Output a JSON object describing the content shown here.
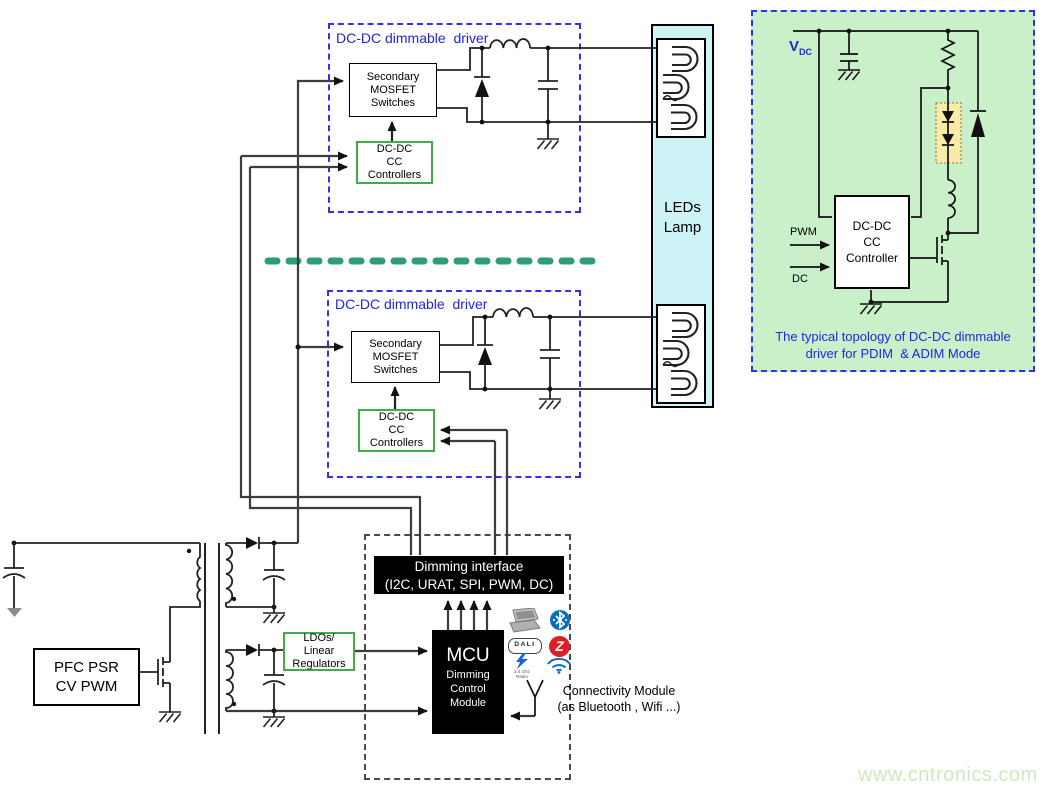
{
  "watermark": "www.cntronics.com",
  "driver1": {
    "label": "DC-DC dimmable  driver",
    "switches": {
      "l1": "Secondary",
      "l2": "MOSFET",
      "l3": "Switches"
    },
    "controllers": {
      "l1": "DC-DC",
      "l2": "CC",
      "l3": "Controllers"
    }
  },
  "driver2": {
    "label": "DC-DC dimmable  driver",
    "switches": {
      "l1": "Secondary",
      "l2": "MOSFET",
      "l3": "Switches"
    },
    "controllers": {
      "l1": "DC-DC",
      "l2": "CC",
      "l3": "Controllers"
    }
  },
  "lamp": {
    "l1": "LEDs",
    "l2": "Lamp"
  },
  "panel": {
    "vdc": "V",
    "vdc_sub": "DC",
    "pwm": "PWM",
    "dc": "DC",
    "controller": {
      "l1": "DC-DC",
      "l2": "CC",
      "l3": "Controller"
    },
    "caption": {
      "l1": "The typical topology of DC-DC dimmable",
      "l2": "driver for PDIM  & ADIM Mode"
    }
  },
  "psu": {
    "pfc": {
      "l1": "PFC PSR",
      "l2": "CV PWM"
    },
    "ldo": {
      "l1": "LDOs/",
      "l2": "Linear",
      "l3": "Regulators"
    }
  },
  "control": {
    "interface": {
      "l1": "Dimming interface",
      "l2": "(I2C, URAT, SPI, PWM, DC)"
    },
    "mcu": {
      "title": "MCU",
      "l1": "Dimming",
      "l2": "Control",
      "l3": "Module"
    },
    "connectivity": {
      "l1": "Connectivity Module",
      "l2": "(as Bluetooth , Wifi ...)"
    },
    "icons": {
      "dali": "DALI",
      "zigbee": "Z",
      "radio_l1": "2.4 Ghz",
      "radio_l2": "Radio"
    }
  },
  "colors": {
    "accent_blue": "#2323e6",
    "green_border": "#3fae49",
    "panel_bg": "#c9f0c9",
    "lamp_bg": "#cdf3f7",
    "separator_green": "#2e9e72",
    "led_highlight": "#f8eba9",
    "watermark_green": "#cfe9c0",
    "black_box": "#000000"
  }
}
